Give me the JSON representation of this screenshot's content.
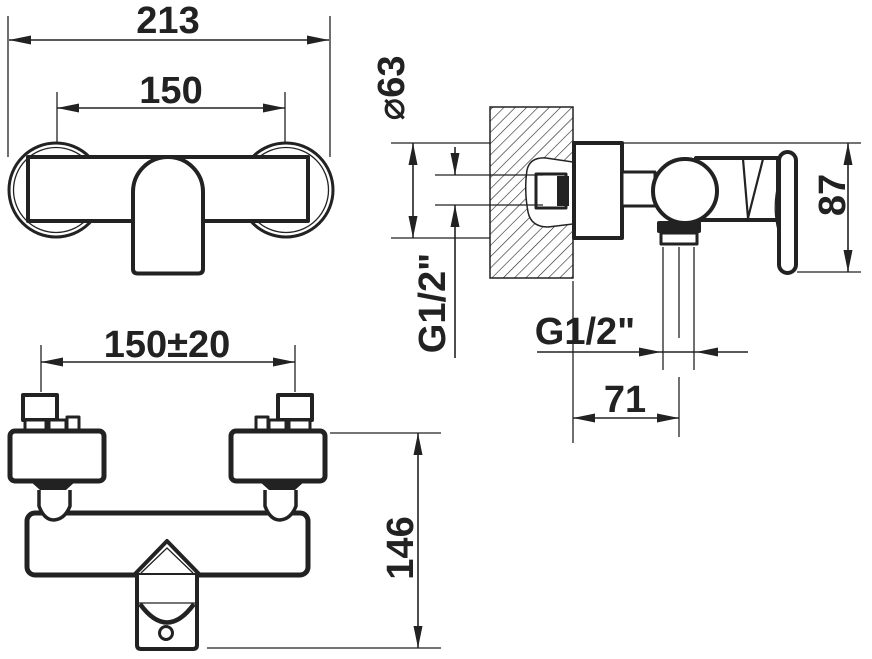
{
  "page": {
    "background": "#ffffff",
    "ink": "#222222",
    "drawing_type": "technical dimension drawing of wall-mounted shower mixer tap"
  },
  "dims": {
    "overall_width": "213",
    "hole_spacing": "150",
    "escutcheon_diameter": "⌀63",
    "inlet_thread": "G1/2\"",
    "outlet_thread": "G1/2\"",
    "height": "87",
    "outlet_offset": "71",
    "bottom_hole_spacing": "150±20",
    "depth": "146"
  }
}
